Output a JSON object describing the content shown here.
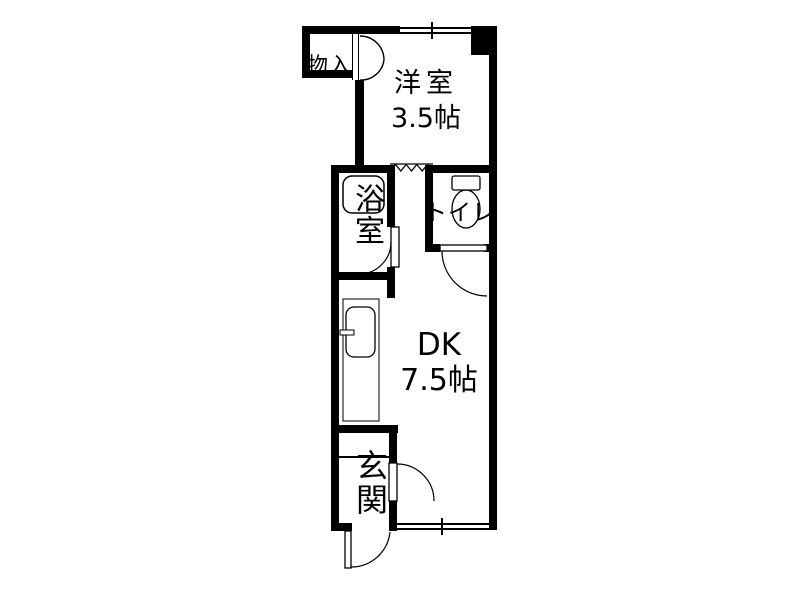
{
  "title": "apartment floor plan",
  "colors": {
    "wall": "#000000",
    "background": "#ffffff",
    "fixture_outline": "#000000"
  },
  "rooms": {
    "closet": {
      "label": "物入"
    },
    "western": {
      "label": "洋室",
      "size": "3.5帖"
    },
    "bath": {
      "label": "浴室"
    },
    "toilet": {
      "label": "トイレ"
    },
    "dk": {
      "label": "DK",
      "size": "7.5帖"
    },
    "entrance": {
      "label": "玄関"
    }
  },
  "fixtures": [
    "bathtub",
    "toilet-bowl",
    "toilet-tank",
    "kitchen-sink",
    "kitchen-faucet"
  ],
  "openings": [
    "closet-double-door",
    "accordion-partition",
    "bath-door",
    "toilet-door",
    "entrance-hall-door",
    "front-entrance-door",
    "top-window",
    "bottom-window"
  ]
}
